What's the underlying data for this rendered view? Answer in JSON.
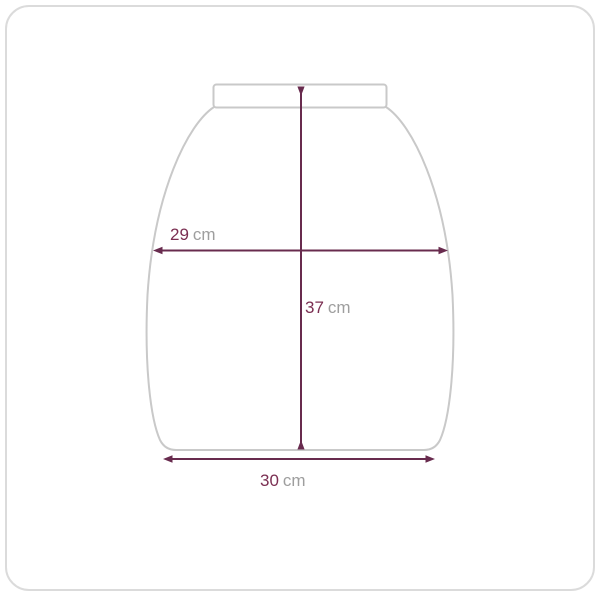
{
  "diagram": {
    "type": "product-dimension-diagram",
    "shape": "rounded container body with flat top rim and flat bottom"
  },
  "measurements": {
    "middle_width": {
      "value": "29",
      "unit": "cm"
    },
    "height": {
      "value": "37",
      "unit": "cm"
    },
    "bottom_width": {
      "value": "30",
      "unit": "cm"
    }
  },
  "icons": {
    "arrowhead": "triangle"
  },
  "colors": {
    "dimension_line": "#682b4e",
    "measurement_value_text": "#7b2f52",
    "measurement_unit_text": "#9e9e9e",
    "product_outline": "#c9c9c9",
    "card_border": "#dbdbdb",
    "background": "#ffffff"
  }
}
